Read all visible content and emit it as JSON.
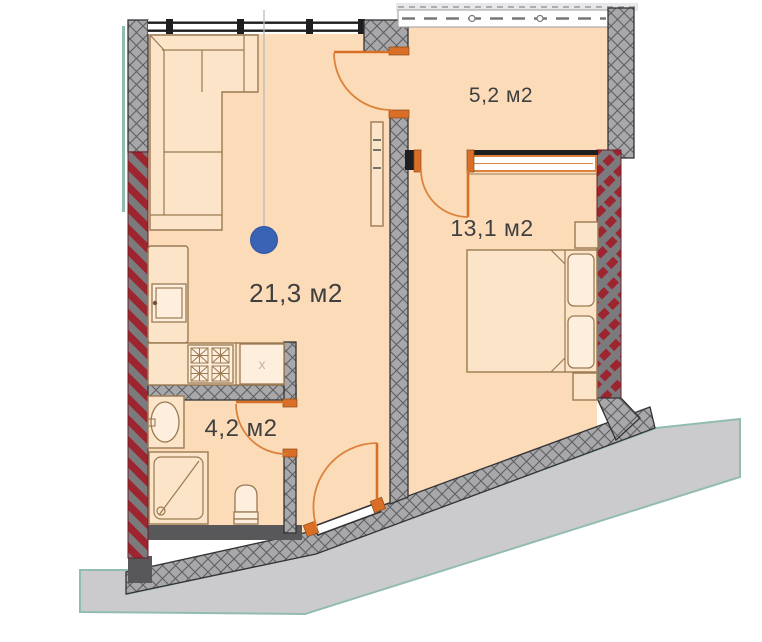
{
  "plan": {
    "type": "apartment-floor-plan",
    "rooms": [
      {
        "id": "living-kitchen",
        "area_label": "21,3 м2"
      },
      {
        "id": "bedroom",
        "area_label": "13,1 м2"
      },
      {
        "id": "balcony",
        "area_label": "5,2 м2"
      },
      {
        "id": "bathroom",
        "area_label": "4,2 м2"
      }
    ],
    "marks": {
      "dishwasher": "x"
    }
  },
  "colors": {
    "floor": "#fcdcb8",
    "furn": "#fce4c8",
    "tan": "#9a7a52",
    "wallgray": "#a8a8ab",
    "hatchline": "#5f5f62",
    "linedark": "#333335",
    "red": "#9d2530",
    "redbg": "#7b7b7e",
    "orange": "#dc823c",
    "orangedark": "#d96f27",
    "blue": "#3a63b6",
    "teal": "#93bcb1",
    "terrace": "#cbcbce",
    "winblack": "#1e1e20",
    "darkband": "#58585a",
    "text": "#3f3f41"
  }
}
